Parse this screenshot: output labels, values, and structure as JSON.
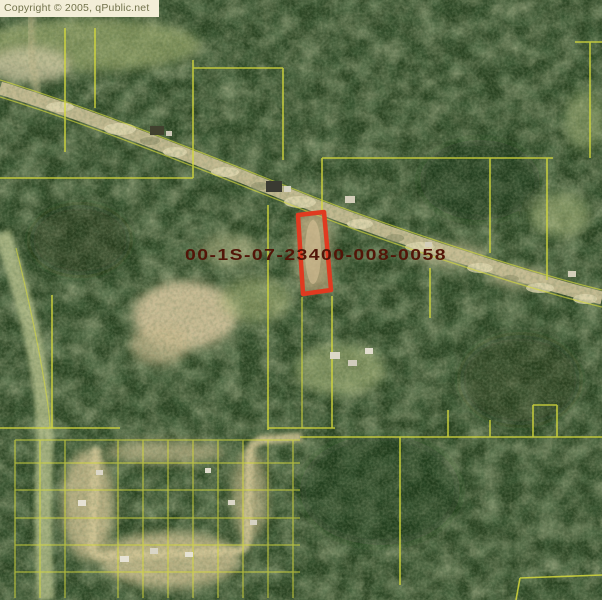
{
  "copyright_notice": "Copyright © 2005, qPublic.net",
  "map": {
    "description": "Aerial photo parcel map with one parcel highlighted in red",
    "parcel_id_label": "00-1S-07-23400-008-0058",
    "colors": {
      "highlight_outline": "#e03a20",
      "parcel_line": "#d6da3c",
      "label_text": "#521508",
      "banner_bg": "#f3eed8",
      "banner_text": "#72724c",
      "forest": "#2a4322",
      "road": "#c8bd93"
    }
  }
}
